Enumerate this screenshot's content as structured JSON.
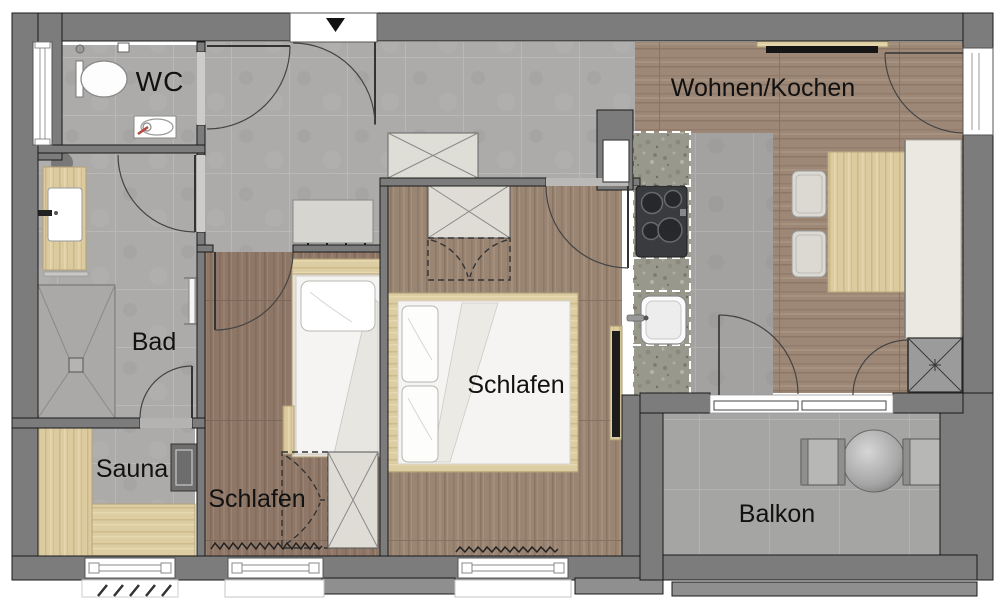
{
  "plan_type": "apartment-floor-plan",
  "rooms": [
    {
      "id": "wc",
      "label": "WC"
    },
    {
      "id": "bad",
      "label": "Bad"
    },
    {
      "id": "sauna",
      "label": "Sauna"
    },
    {
      "id": "schlafen-klein",
      "label": "Schlafen"
    },
    {
      "id": "schlafen-gross",
      "label": "Schlafen"
    },
    {
      "id": "wohnen-kochen",
      "label": "Wohnen/Kochen"
    },
    {
      "id": "balkon",
      "label": "Balkon"
    }
  ],
  "icons": [
    "entrance-arrow-icon",
    "toilet-icon",
    "washbasin-icon",
    "shower-icon",
    "sauna-heater-icon",
    "cooktop-icon",
    "kitchen-sink-icon",
    "radiator-icon",
    "wardrobe-icon",
    "door-swing-icon",
    "shaft-icon",
    "coat-rack-icon",
    "tv-icon"
  ],
  "colors": {
    "wall": "#7c7c7c",
    "wall-outline": "#1a1a1a",
    "tile-floor": "#acaba9",
    "wood-floor": "#96816f",
    "furniture-wood": "#dccb9f",
    "table-wood": "#ddc88e",
    "counter-granite": "#99988d",
    "bedding": "#f5f4f2",
    "balcony-floor": "#a5a5a3",
    "label-text": "#111111"
  }
}
